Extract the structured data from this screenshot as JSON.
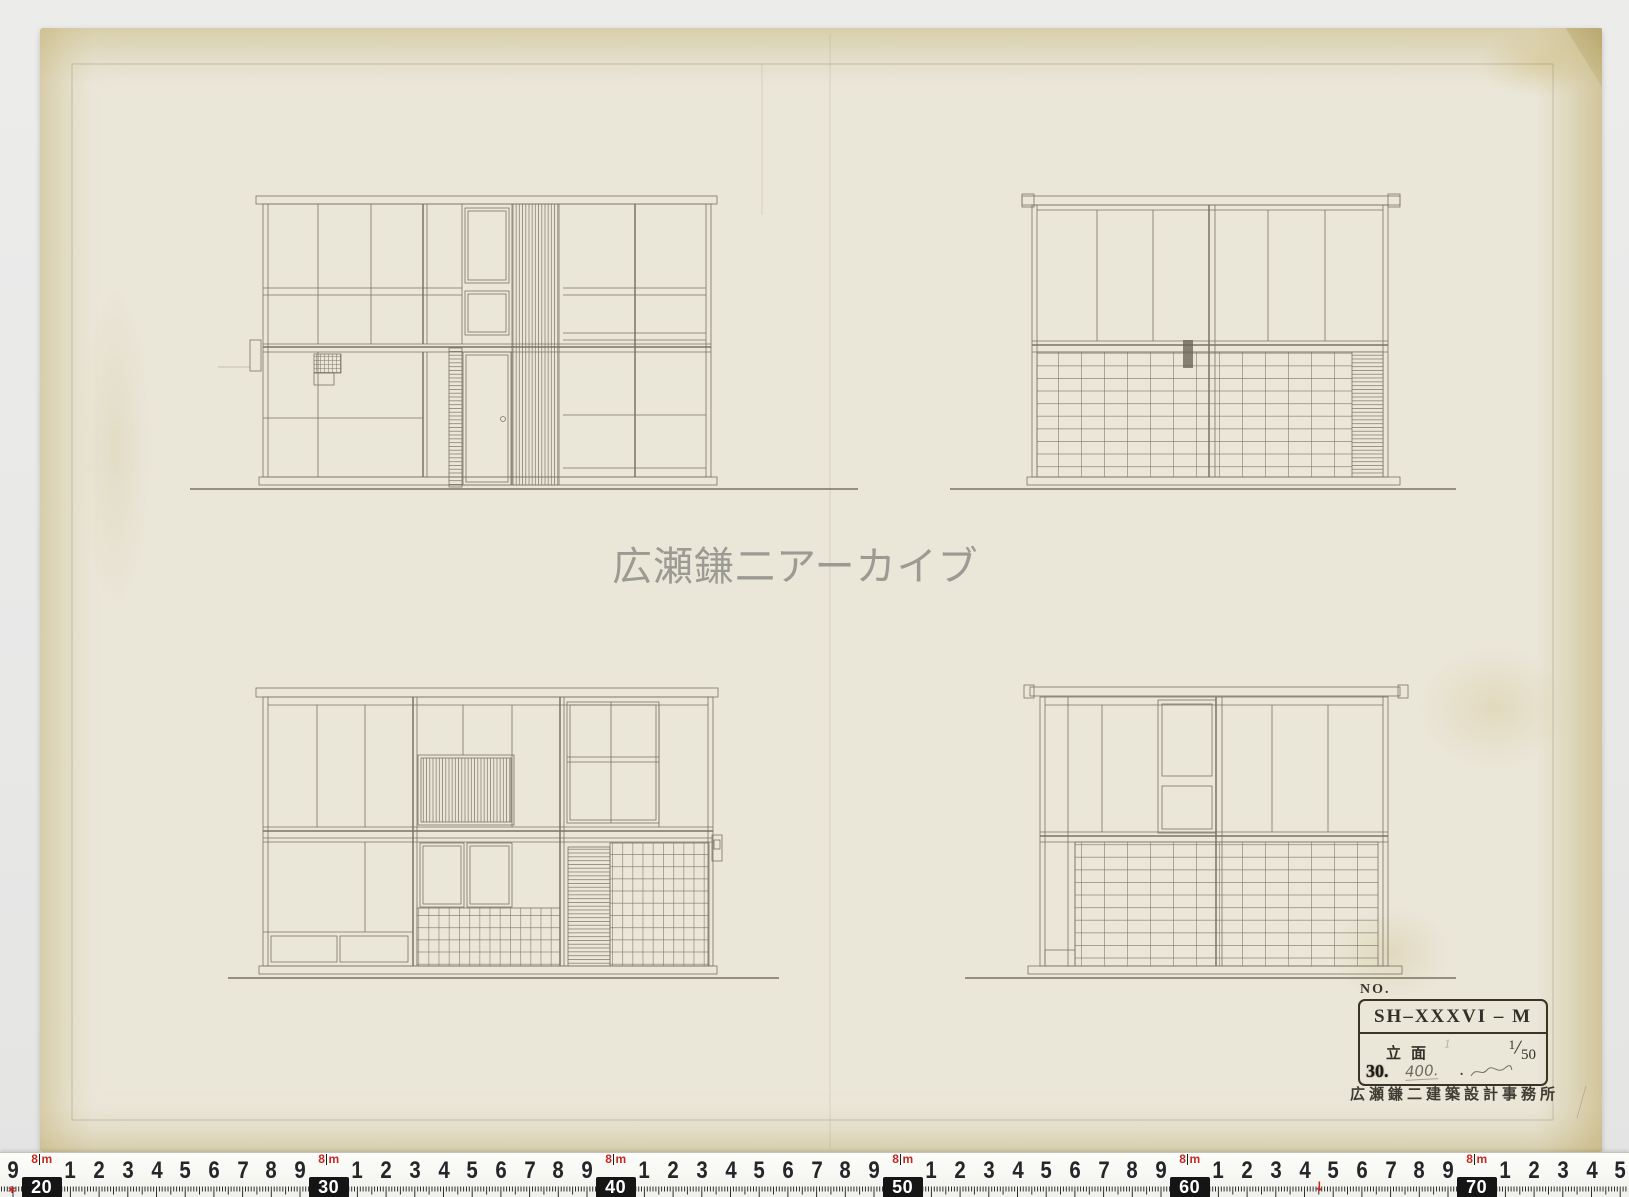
{
  "document": {
    "watermark": "広瀬鎌二アーカイブ",
    "title_block": {
      "no_label": "NO.",
      "drawing_code": "SH–XXXVI – M",
      "drawing_type": "立面",
      "scale_numerator": "1",
      "scale_denominator": "50",
      "sheet_number": "30.",
      "handwritten_note": "400.",
      "dot": ".",
      "pencil_mark": "1",
      "office_stamp": "広瀬鎌二建築設計事務所"
    }
  },
  "ruler": {
    "start_cm": 19,
    "end_cm": 75,
    "origin_x": 13,
    "px_per_cm": 28.7,
    "meter_prefix": "8",
    "meter_unit": "m",
    "start_marker": "*",
    "arrow_marker": "↓",
    "start_marker_x": 13,
    "arrow_marker_x": 1318
  },
  "colors": {
    "background": "#e9e9e8",
    "paper": "#eae6d8",
    "paper_edge": "#d9cda2",
    "pencil": "#7a7365",
    "stamp_ink": "#332e26",
    "watermark": "#8e8e88",
    "tape_white": "#f7f7f4",
    "tape_red": "#c62820"
  }
}
